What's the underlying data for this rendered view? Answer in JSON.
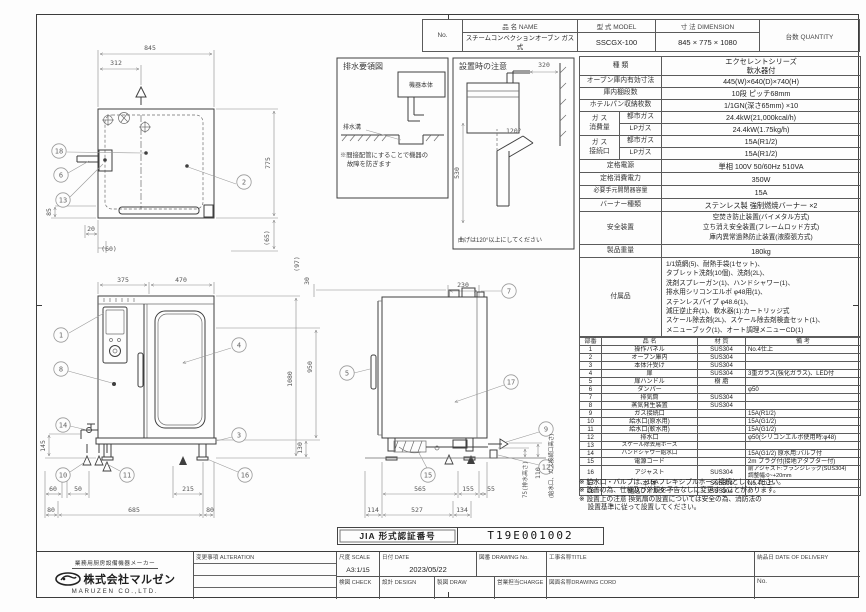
{
  "header_table": {
    "no_label": "No.",
    "name_label": "品 名  NAME",
    "model_label": "型 式  MODEL",
    "dim_label": "寸 法  DIMENSION",
    "qty_label": "台数 QUANTITY",
    "name_value": "スチームコンベクションオーブン ガス式",
    "model_value": "SSCGX-100",
    "dim_value": "845 × 775 × 1080",
    "qty_value": ""
  },
  "spec_table": {
    "kind_label": "種  類",
    "kind_value": "エクセレントシリーズ\n軟水器付",
    "cavity_label": "オーブン庫内有効寸法",
    "cavity_value": "445(W)×640(D)×740(H)",
    "shelf_label": "庫内棚段数",
    "shelf_value": "10段 ピッチ68mm",
    "pan_label": "ホテルパン収納枚数",
    "pan_value": "1/1GN(深さ65mm) ×10",
    "gas_consumption_group": "ガ ス\n消費量",
    "gas_connection_group": "ガ ス\n接続口",
    "city_gas_label": "都市ガス",
    "lp_gas_label": "LPガス",
    "consumption_city": "24.4kW(21,000kcal/h)",
    "consumption_lp": "24.4kW(1.75kg/h)",
    "connection_city": "15A(R1/2)",
    "connection_lp": "15A(R1/2)",
    "power_label": "定格電源",
    "power_value": "単相 100V 50/60Hz 510VA",
    "wattage_label": "定格消費電力",
    "wattage_value": "350W",
    "breaker_label": "必要手元開閉器容量",
    "breaker_value": "15A",
    "burner_label": "バーナー種類",
    "burner_value": "ステンレス製 強制燃焼バーナー ×2",
    "safety_label": "安全装置",
    "safety_value": "空焚き防止装置(バイメタル方式)\n立ち消え安全装置(フレームロッド方式)\n庫内異常過熱防止装置(液膨張方式)",
    "weight_label": "製品重量",
    "weight_value": "180kg",
    "accessories_label": "付属品",
    "accessories_value": "1/1焼網(5)、耐熱手袋(1セット)、\nタブレット洗剤(10個)、洗剤(2L)、\n洗剤スプレーガン(1)、ハンドシャワー(1)、\n排水用シリコンエルボ φ48用(1)、\nステンレスパイプ φ48.6(1)、\n減圧逆止弁(1)、軟水器(1):カートリッジ式\nスケール除去剤(2L)、スケール除去剤検査セット(1)、\nメニューブック(1)、オート調理メニューCD(1)"
  },
  "parts_table": {
    "headers": [
      "部番",
      "品  名",
      "材 質",
      "備  考"
    ],
    "rows": [
      [
        "1",
        "操作パネル",
        "SUS304",
        "No.4仕上"
      ],
      [
        "2",
        "オーブン庫内",
        "SUS304",
        ""
      ],
      [
        "3",
        "本体汁受け",
        "SUS304",
        ""
      ],
      [
        "4",
        "扉",
        "SUS304",
        "3重ガラス(強化ガラス)、LED付"
      ],
      [
        "5",
        "扉ハンドル",
        "樹 脂",
        ""
      ],
      [
        "6",
        "ダンパー",
        "",
        "φ50"
      ],
      [
        "7",
        "排気筒",
        "SUS304",
        ""
      ],
      [
        "8",
        "蒸気発生装置",
        "SUS304",
        ""
      ],
      [
        "9",
        "ガス接続口",
        "",
        "15A(R1/2)"
      ],
      [
        "10",
        "給水口(原水用)",
        "",
        "15A(G1/2)"
      ],
      [
        "11",
        "給水口(軟水用)",
        "",
        "15A(G1/2)"
      ],
      [
        "12",
        "排水口",
        "",
        "φ50(シリコンエルボ使用時:φ48)"
      ],
      [
        "13",
        "スケール除去用ホース",
        "",
        ""
      ],
      [
        "14",
        "ハンドシャワー給水口",
        "",
        "15A(G1/2) 原水用:バルブ付"
      ],
      [
        "15",
        "電源コード",
        "",
        "2m プラグ付(接地アダプター付)"
      ],
      [
        "16",
        "アジャスト",
        "SUS304",
        "前アジャスト:フランジレッグ(SUS304)\n調整幅:0~+20mm"
      ],
      [
        "17",
        "本 体",
        "SUS304",
        "No.4仕上"
      ],
      [
        "18",
        "組込フィルター",
        "SUS304",
        ""
      ]
    ]
  },
  "notes": [
    "※ 給水口・バルブは、15Aフレキシブルホース接続としてください。",
    "※ 改善の為、仕様及び外観を予告なしに変更することがあります。",
    "※ 設置上の注意 換気扇の設置については安全の為、消防法の\n　 設置基準に従って設置してください。"
  ],
  "certification": {
    "label": "JIA 形式認証番号",
    "value": "T19E001002"
  },
  "title_block": {
    "maker_tagline": "業務用厨房設備機器メーカー",
    "maker_name": "株式会社マルゼン",
    "maker_en": "MARUZEN CO.,LTD.",
    "alteration_label": "変更事項 ALTERATION",
    "scale_label": "尺度 SCALE",
    "scale_value": "A3:1/15",
    "date_label": "日付 DATE",
    "date_value": "2023/05/22",
    "drawing_no_label": "図番 DRAWING No.",
    "title_label": "工事名称TITLE",
    "delivery_label": "納品日 DATE OF DELIVERY",
    "check_label": "検図 CHECK",
    "design_label": "設計 DESIGN",
    "draw_label": "製図 DRAW",
    "charge_label": "営業担当CHARGE",
    "drawing_name_label": "図面名称DRAWING CORD",
    "no_label": "No."
  },
  "drawings": {
    "top_view": {
      "d845": "845",
      "d312": "312",
      "d775": "775",
      "d85": "85",
      "d20": "20",
      "d60": "(60)",
      "d65": "(65)",
      "balloons": {
        "b18": "18",
        "b6": "6",
        "b13": "13",
        "b2": "2"
      }
    },
    "drain_guide": {
      "title": "排水要領図",
      "body_label": "機器本体",
      "trench_label": "排水溝",
      "note_line1": "※間接配管にすることで機器の",
      "note_line2": "故障を防ぎます"
    },
    "install_note": {
      "title": "設置時の注意",
      "d320": "320",
      "d530": "530",
      "angle": "120°",
      "caption": "曲げは120°以上にしてください"
    },
    "front_view": {
      "d375": "375",
      "d470": "470",
      "d145": "145",
      "d60": "60",
      "d50": "50",
      "d215": "215",
      "d80_left": "80",
      "d685": "685",
      "d80_right": "80",
      "d1080": "1080",
      "d950": "950",
      "d130": "130",
      "balloons": {
        "b1": "1",
        "b4": "4",
        "b8": "8",
        "b14": "14",
        "b10": "10",
        "b11": "11",
        "b3": "3",
        "b16": "16"
      }
    },
    "side_view": {
      "d97": "(97)",
      "d30": "30",
      "d230": "230",
      "d565": "565",
      "d155": "155",
      "d55": "55",
      "d114": "114",
      "d527": "527",
      "d134": "134",
      "d110": "110",
      "d75": "75(排水高さ)",
      "gas_height_note": "(給水口、ガス接続口高さ)",
      "balloons": {
        "b5": "5",
        "b7": "7",
        "b17": "17",
        "b9": "9",
        "b12": "12",
        "b15": "15"
      }
    }
  }
}
